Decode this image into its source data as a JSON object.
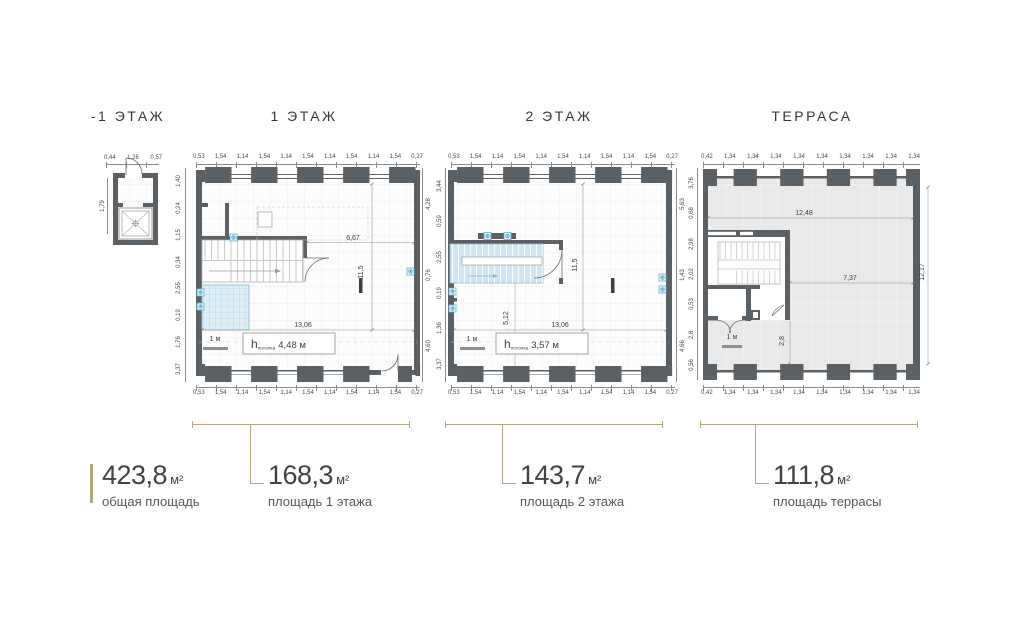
{
  "colors": {
    "accent": "#b2a77c",
    "wall": "#5b6064",
    "stair_blue_fill": "#cfe7f3",
    "blue_stroke": "#5fb0cc",
    "terrace_floor": "#e9e9e9",
    "dim_line": "#8a8a8a",
    "text_dark": "#3f4347"
  },
  "plans": {
    "basement": {
      "title": "-1 ЭТАЖ",
      "top_dims": [
        "0,44",
        "1,26",
        "0,57"
      ],
      "left_dims": [
        "1,79"
      ]
    },
    "floor1": {
      "title": "1 ЭТАЖ",
      "top_dims": [
        "0,53",
        "1,54",
        "1,14",
        "1,54",
        "1,14",
        "1,54",
        "1,14",
        "1,54",
        "1,14",
        "1,54",
        "0,27"
      ],
      "left_dims": [
        "1,40",
        "0,24",
        "1,15",
        "0,34",
        "2,55",
        "0,19",
        "1,76",
        "3,37"
      ],
      "right_dims": [
        "4,28",
        "0,76",
        "4,60"
      ],
      "dim_upper": "6,67",
      "dim_height": "11,5",
      "dim_width": "13,06",
      "scale_label": "1 м",
      "ceiling_h": "h",
      "ceiling_sub": "потолка",
      "ceiling_val": "4,48 м"
    },
    "floor2": {
      "title": "2 ЭТАЖ",
      "top_dims": [
        "0,53",
        "1,54",
        "1,14",
        "1,54",
        "1,14",
        "1,54",
        "1,14",
        "1,54",
        "1,14",
        "1,54",
        "0,27"
      ],
      "left_dims": [
        "3,44",
        "0,59",
        "2,55",
        "0,19",
        "1,36",
        "3,37"
      ],
      "right_dims": [
        "5,63",
        "1,43",
        "4,66"
      ],
      "dim_height": "11,5",
      "dim_stair": "5,12",
      "dim_width": "13,06",
      "scale_label": "1 м",
      "ceiling_h": "h",
      "ceiling_sub": "потолка",
      "ceiling_val": "3,57 м"
    },
    "terrace": {
      "title": "ТЕРРАСА",
      "top_dims": [
        "0,42",
        "1,34",
        "1,34",
        "1,34",
        "1,34",
        "1,34",
        "1,34",
        "1,34",
        "1,34",
        "1,34"
      ],
      "left_dims": [
        "3,76",
        "0,68",
        "2,98",
        "2,02",
        "0,53",
        "2,8",
        "0,56"
      ],
      "dim_upper": "12,48",
      "dim_mid": "7,37",
      "dim_lower": "2,8",
      "dim_right": "12,17",
      "scale_label": "1 м"
    }
  },
  "areas": [
    {
      "value": "423,8",
      "unit": "м²",
      "label": "общая площадь"
    },
    {
      "value": "168,3",
      "unit": "м²",
      "label": "площадь 1 этажа"
    },
    {
      "value": "143,7",
      "unit": "м²",
      "label": "площадь 2 этажа"
    },
    {
      "value": "111,8",
      "unit": "м²",
      "label": "площадь террасы"
    }
  ]
}
